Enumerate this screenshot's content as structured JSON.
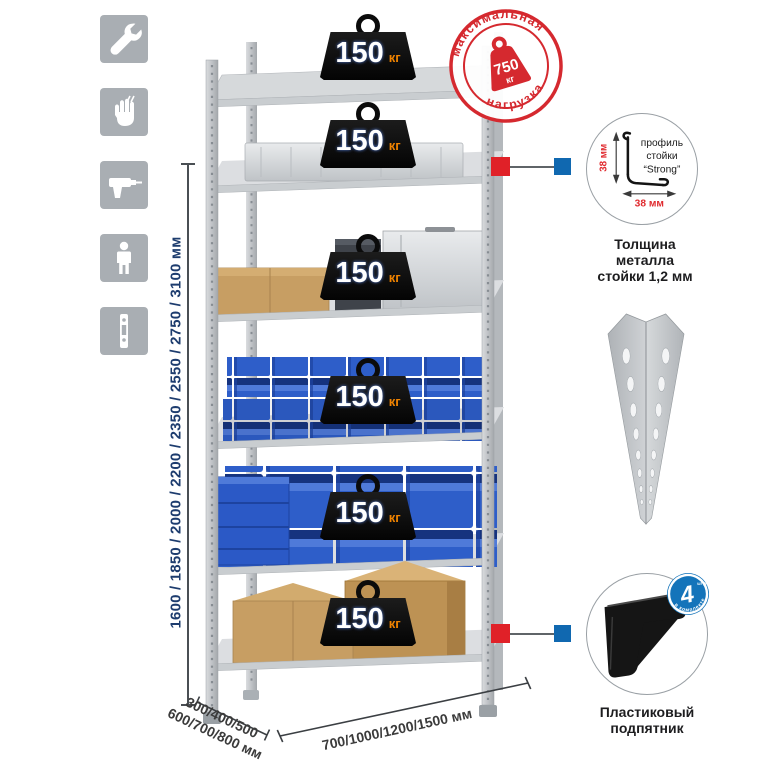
{
  "title": "shelving-rack-infographic",
  "icons": [
    {
      "name": "wrench-icon"
    },
    {
      "name": "gloves-icon"
    },
    {
      "name": "drill-icon"
    },
    {
      "name": "person-icon"
    },
    {
      "name": "level-icon"
    }
  ],
  "dimensions": {
    "height_label": "1600 / 1850 / 2000 / 2200 / 2350 / 2550 / 2750 / 3100 мм",
    "depth_line1": "300/400/500",
    "depth_line2": "600/700/800 мм",
    "width_label": "700/1000/1200/1500 мм"
  },
  "shelves": [
    {
      "load": "150",
      "unit": "кг"
    },
    {
      "load": "150",
      "unit": "кг"
    },
    {
      "load": "150",
      "unit": "кг"
    },
    {
      "load": "150",
      "unit": "кг"
    },
    {
      "load": "150",
      "unit": "кг"
    },
    {
      "load": "150",
      "unit": "кг"
    }
  ],
  "stamp": {
    "arc_top": "максимальная",
    "arc_bottom": "нагрузка",
    "value": "750",
    "unit": "кг"
  },
  "profile_detail": {
    "label_line1": "профиль",
    "label_line2": "стойки",
    "label_line3": "“Strong”",
    "dim_vertical": "38 мм",
    "dim_horizontal": "38 мм",
    "caption_line1": "Толщина металла",
    "caption_line2": "стойки 1,2 мм"
  },
  "foot_detail": {
    "caption_line1": "Пластиковый",
    "caption_line2": "подпятник",
    "kit_count": "4",
    "kit_count_unit": "штуки",
    "kit_arc_label": "в комплекте"
  },
  "colors": {
    "stamp_red": "#d5292f",
    "accent_red": "#e02128",
    "accent_blue": "#1068b0",
    "bin_blue": "#2e5ec9",
    "kg_orange": "#f08300",
    "dim_text_blue": "#1d3c6e",
    "icon_gray": "#a9aeb3"
  }
}
